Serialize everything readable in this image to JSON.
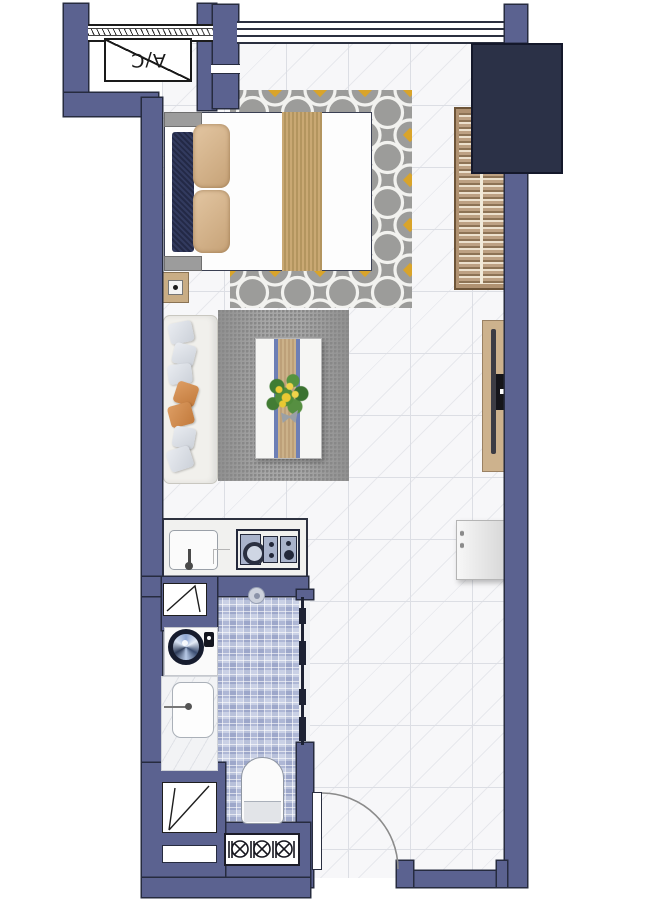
{
  "plan": {
    "type": "studio-apartment-floor-plan",
    "labels": {
      "ac": "A/C"
    },
    "colors": {
      "wall": "#5b6290",
      "wall_outline": "#262b3f",
      "shaft_box": "#2b3147",
      "floor_tile": "#f7f7f9",
      "tile_grout": "#dcdee4",
      "bedroom_rug_gray": "#9c9c9a",
      "rug_accent_gold": "#d9a42a",
      "living_rug_gray": "#a0a0a0",
      "wood_tan": "#cdb28d",
      "bathroom_mosaic_blue": "#b6bfda",
      "bed_runner_navy": "#262c49",
      "pillow_tan": "#d2b28c",
      "sofa_pillow_orange": "#d08a50",
      "plant_green": "#4d8a3d",
      "flower_yellow": "#e9c832"
    },
    "rooms": [
      "ac-ledge",
      "bedroom",
      "living-area",
      "kitchen",
      "bathroom",
      "entry"
    ],
    "fixtures": [
      "north-window",
      "double-bed",
      "bed-pillows",
      "nightstand-lamp",
      "wardrobe",
      "service-shaft",
      "sofa",
      "coffee-table",
      "plant",
      "tv-console",
      "kitchen-sink",
      "cooktop-4-burner",
      "refrigerator",
      "washing-machine",
      "bathroom-sink",
      "shower-drain",
      "glass-partition",
      "toilet",
      "vent-grille",
      "entry-door"
    ]
  }
}
